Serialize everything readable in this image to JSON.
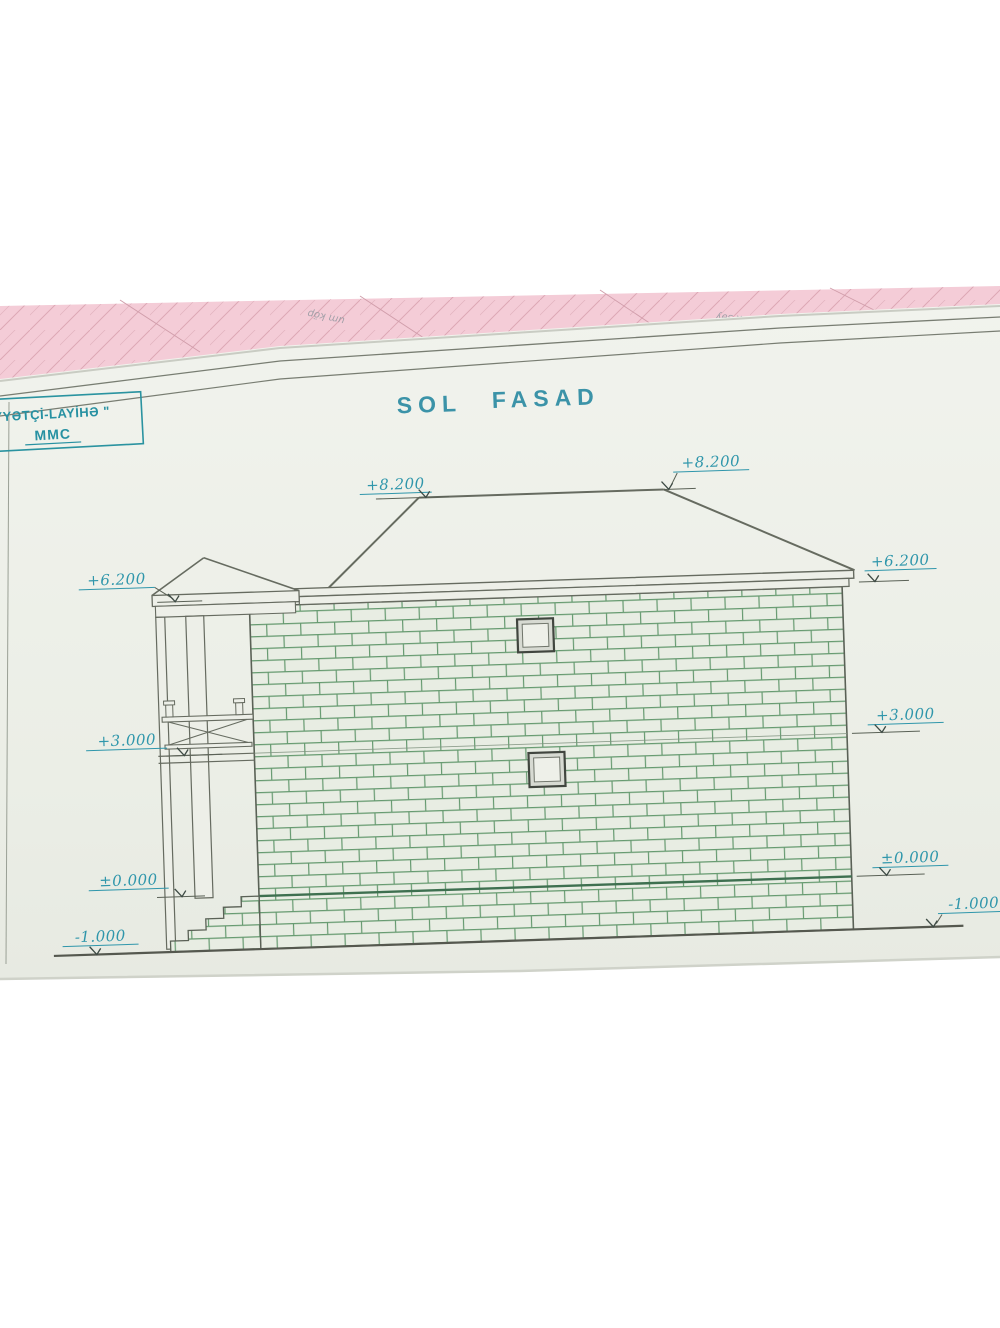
{
  "title": {
    "word1": "SOL",
    "word2": "FASAD"
  },
  "stamp": {
    "line1": "YYƏTÇİ-LAYİHƏ \"",
    "line2": "MMC"
  },
  "markers": {
    "ridge_left": "+8.200",
    "ridge_right": "+8.200",
    "eave_left": "+6.200",
    "eave_right": "+6.200",
    "floor_left": "+3.000",
    "floor_right": "+3.000",
    "ground_floor_left": "±0.000",
    "ground_floor_right": "±0.000",
    "terrain_left": "-1.000",
    "terrain_right": "-1.000"
  },
  "background_fragments": [
    "um köp",
    "alın (ə",
    "x səy"
  ],
  "colors": {
    "teal_ink": "#2f96ab",
    "drawing_line": "#666b60",
    "brick_mortar_green": "#4f8c5c",
    "paper": "#edefe8",
    "pink_sheet": "#f4ccd7"
  }
}
